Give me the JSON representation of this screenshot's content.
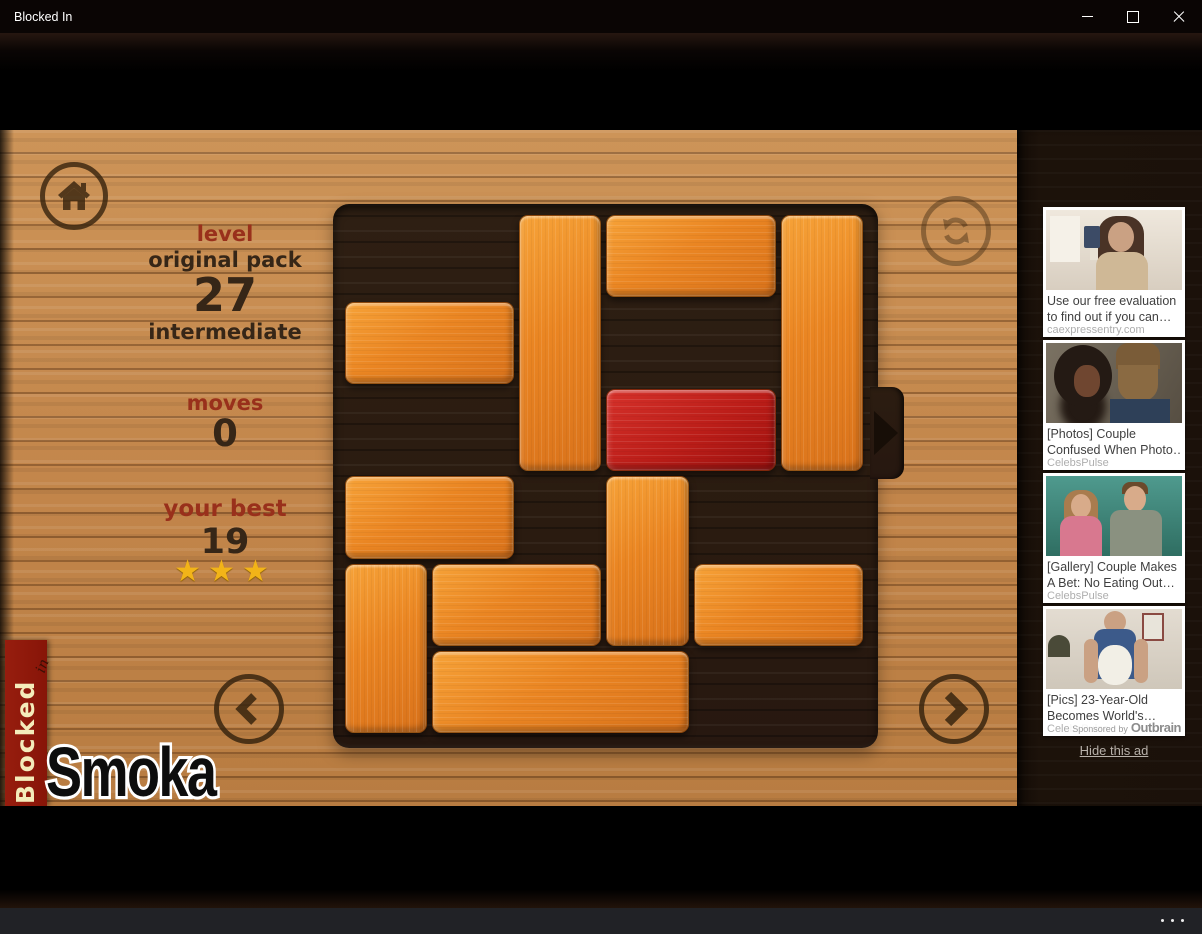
{
  "window": {
    "title": "Blocked In",
    "icons": {
      "minimize": "minimize-icon",
      "maximize": "maximize-icon",
      "close": "close-icon",
      "more_menu": "ellipsis-icon"
    }
  },
  "hud": {
    "level_label": "level",
    "pack": "original pack",
    "level_number": "27",
    "difficulty": "intermediate",
    "moves_label": "moves",
    "moves_value": "0",
    "best_label": "your best",
    "best_value": "19",
    "stars": "★★★"
  },
  "watermark": {
    "ribbon_title": "Blocked",
    "ribbon_sub": "in",
    "signature": "Smoka"
  },
  "board": {
    "grid": 6,
    "cell": 87.3,
    "exit_row": 2,
    "blocks": [
      {
        "col": 2,
        "row": 0,
        "w": 1,
        "h": 3,
        "type": "orange"
      },
      {
        "col": 3,
        "row": 0,
        "w": 2,
        "h": 1,
        "type": "orange"
      },
      {
        "col": 5,
        "row": 0,
        "w": 1,
        "h": 3,
        "type": "orange"
      },
      {
        "col": 0,
        "row": 1,
        "w": 2,
        "h": 1,
        "type": "orange"
      },
      {
        "col": 3,
        "row": 2,
        "w": 2,
        "h": 1,
        "type": "red"
      },
      {
        "col": 0,
        "row": 3,
        "w": 2,
        "h": 1,
        "type": "orange"
      },
      {
        "col": 3,
        "row": 3,
        "w": 1,
        "h": 2,
        "type": "orange"
      },
      {
        "col": 0,
        "row": 4,
        "w": 1,
        "h": 2,
        "type": "orange"
      },
      {
        "col": 1,
        "row": 4,
        "w": 2,
        "h": 1,
        "type": "orange"
      },
      {
        "col": 4,
        "row": 4,
        "w": 2,
        "h": 1,
        "type": "orange"
      },
      {
        "col": 1,
        "row": 5,
        "w": 3,
        "h": 1,
        "type": "orange"
      }
    ]
  },
  "ads": {
    "items": [
      {
        "title_line1": "Use our free evaluation",
        "title_line2": "to find out if you can…",
        "source": "caexpressentry.com"
      },
      {
        "title_line1": "[Photos] Couple",
        "title_line2": "Confused When Photo…",
        "source": "CelebsPulse"
      },
      {
        "title_line1": "[Gallery] Couple Makes",
        "title_line2": "A Bet: No Eating Out…",
        "source": "CelebsPulse"
      },
      {
        "title_line1": "[Pics] 23-Year-Old",
        "title_line2": "Becomes World's…",
        "source": "CelebsPulse"
      }
    ],
    "sponsored_prefix": "Sponsored by",
    "network": "Outbrain",
    "hide_label": "Hide this ad"
  },
  "colors": {
    "wood_light": "#c2854a",
    "board_dark": "#2a1b10",
    "block_orange": "#ea8522",
    "block_red": "#bb1d18",
    "ribbon_red": "#8e190d",
    "star_gold": "#f2b418",
    "hud_red": "#99301b",
    "hud_brown": "#362617"
  }
}
